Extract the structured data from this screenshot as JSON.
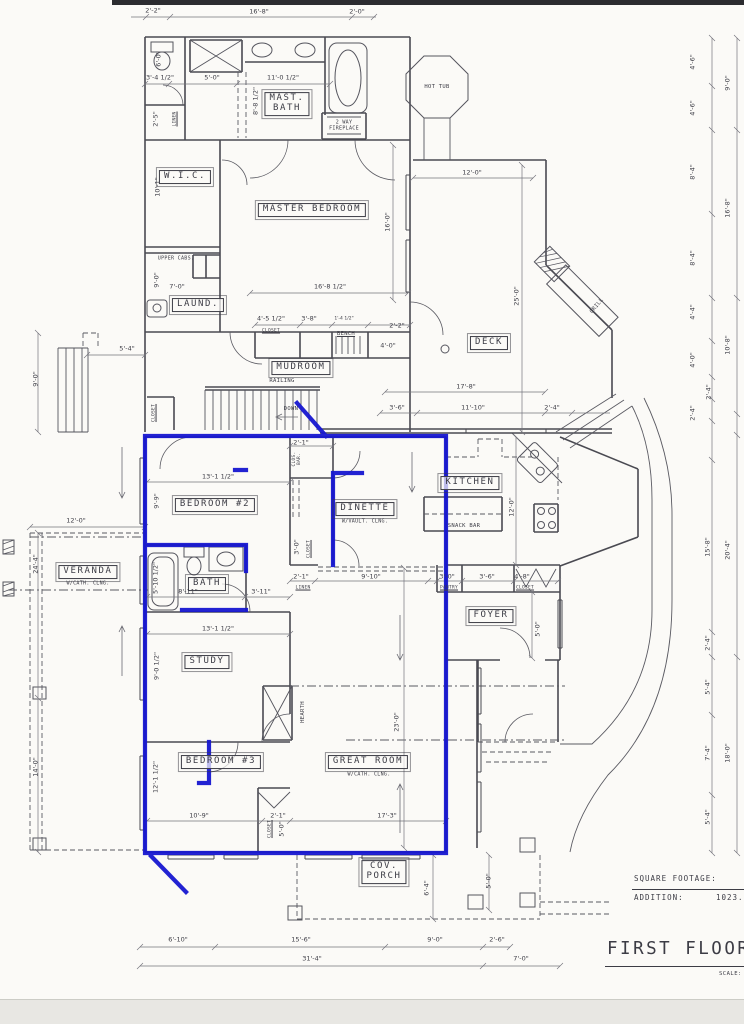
{
  "colors": {
    "highlight_blue": "#1616d0",
    "ink": "#3c3c45",
    "paper": "#fbfaf7"
  },
  "title_block": {
    "square_footage_label": "SQUARE FOOTAGE:",
    "addition_label": "ADDITION:",
    "addition_value": "1023.",
    "sheet_title": "FIRST FLOOR F",
    "scale_label": "SCALE:"
  },
  "rooms": [
    {
      "t": "MAST.\nBATH",
      "x": 287,
      "y": 104,
      "n": "mast-bath"
    },
    {
      "t": "W.I.C.",
      "x": 185,
      "y": 177,
      "n": "wic"
    },
    {
      "t": "MASTER BEDROOM",
      "x": 312,
      "y": 210,
      "n": "master-bedroom"
    },
    {
      "t": "LAUND.",
      "x": 198,
      "y": 305,
      "n": "laundry"
    },
    {
      "t": "MUDROOM",
      "x": 301,
      "y": 368,
      "n": "mudroom"
    },
    {
      "t": "DECK",
      "x": 489,
      "y": 343,
      "n": "deck"
    },
    {
      "t": "KITCHEN",
      "x": 470,
      "y": 483,
      "n": "kitchen"
    },
    {
      "t": "DINETTE",
      "x": 365,
      "y": 509,
      "n": "dinette"
    },
    {
      "t": "BEDROOM #2",
      "x": 215,
      "y": 505,
      "n": "bedroom-2"
    },
    {
      "t": "BATH",
      "x": 207,
      "y": 584,
      "n": "bath"
    },
    {
      "t": "VERANDA",
      "x": 88,
      "y": 572,
      "n": "veranda"
    },
    {
      "t": "STUDY",
      "x": 207,
      "y": 662,
      "n": "study"
    },
    {
      "t": "BEDROOM #3",
      "x": 221,
      "y": 762,
      "n": "bedroom-3"
    },
    {
      "t": "GREAT ROOM",
      "x": 368,
      "y": 762,
      "n": "great-room"
    },
    {
      "t": "FOYER",
      "x": 491,
      "y": 616,
      "n": "foyer"
    },
    {
      "t": "COV.\nPORCH",
      "x": 384,
      "y": 872,
      "n": "cov-porch"
    }
  ],
  "labels": [
    {
      "t": "HOT TUB",
      "x": 437,
      "y": 87
    },
    {
      "t": "2 WAY\nFIREPLACE",
      "x": 344,
      "y": 126,
      "fs": 5
    },
    {
      "t": "GRILL",
      "x": 597,
      "y": 306,
      "rot": -50
    },
    {
      "t": "SNACK BAR",
      "x": 464,
      "y": 526
    },
    {
      "t": "BENCH",
      "x": 346,
      "y": 334,
      "u": 1
    },
    {
      "t": "RAILING",
      "x": 282,
      "y": 381
    },
    {
      "t": "DOWN",
      "x": 291,
      "y": 409
    },
    {
      "t": "UPPER CABS.",
      "x": 176,
      "y": 259,
      "fs": 5
    },
    {
      "t": "HEARTH",
      "x": 303,
      "y": 712,
      "r": 1
    },
    {
      "t": "LINEN",
      "x": 176,
      "y": 119,
      "r": 1,
      "u": 1,
      "fs": 4.5
    },
    {
      "t": "CLOSET",
      "x": 271,
      "y": 332,
      "u": 1,
      "fs": 4.5
    },
    {
      "t": "CLOSET",
      "x": 155,
      "y": 413,
      "r": 1,
      "u": 1,
      "fs": 4.5
    },
    {
      "t": "CLOS.\nBAR.",
      "x": 298,
      "y": 459,
      "r": 1,
      "fs": 4.5
    },
    {
      "t": "CLOSET",
      "x": 310,
      "y": 549,
      "r": 1,
      "u": 1,
      "fs": 4.5
    },
    {
      "t": "LINEN",
      "x": 303,
      "y": 589,
      "u": 1,
      "fs": 4.5
    },
    {
      "t": "PANTRY",
      "x": 449,
      "y": 589,
      "u": 1,
      "fs": 4.5
    },
    {
      "t": "CLOSET",
      "x": 525,
      "y": 589,
      "u": 1,
      "fs": 4.5
    },
    {
      "t": "CLOSET",
      "x": 271,
      "y": 829,
      "r": 1,
      "u": 1,
      "fs": 4.5
    },
    {
      "t": "W/VAULT. CLNG.",
      "x": 365,
      "y": 522,
      "fs": 5
    },
    {
      "t": "W/CATH. CLNG.",
      "x": 88,
      "y": 584,
      "fs": 5
    },
    {
      "t": "W/CATH. CLNG.",
      "x": 369,
      "y": 775,
      "fs": 5
    }
  ],
  "dims": [
    {
      "t": "2'-2\"",
      "x": 153,
      "y": 11
    },
    {
      "t": "16'-8\"",
      "x": 259,
      "y": 12
    },
    {
      "t": "2'-0\"",
      "x": 357,
      "y": 12
    },
    {
      "t": "6'-0\"",
      "x": 159,
      "y": 59,
      "r": 1
    },
    {
      "t": "3'-4 1/2\"",
      "x": 160,
      "y": 78
    },
    {
      "t": "5'-0\"",
      "x": 212,
      "y": 78
    },
    {
      "t": "11'-0 1/2\"",
      "x": 283,
      "y": 78
    },
    {
      "t": "8'-8 1/2\"",
      "x": 256,
      "y": 101,
      "r": 1
    },
    {
      "t": "2'-5\"",
      "x": 156,
      "y": 119,
      "r": 1
    },
    {
      "t": "10'-1\"",
      "x": 158,
      "y": 187,
      "r": 1
    },
    {
      "t": "9'-0\"",
      "x": 157,
      "y": 280,
      "r": 1
    },
    {
      "t": "7'-0\"",
      "x": 177,
      "y": 287
    },
    {
      "t": "16'-0\"",
      "x": 388,
      "y": 222,
      "r": 1
    },
    {
      "t": "16'-8 1/2\"",
      "x": 330,
      "y": 287
    },
    {
      "t": "4'-5 1/2\"",
      "x": 271,
      "y": 319
    },
    {
      "t": "3'-8\"",
      "x": 309,
      "y": 319
    },
    {
      "t": "1'-4 1/2\"",
      "x": 344,
      "y": 320,
      "fs": 4.5
    },
    {
      "t": "2'-2\"",
      "x": 397,
      "y": 326
    },
    {
      "t": "4'-0\"",
      "x": 388,
      "y": 346
    },
    {
      "t": "12'-0\"",
      "x": 472,
      "y": 173
    },
    {
      "t": "25'-0\"",
      "x": 517,
      "y": 296,
      "r": 1
    },
    {
      "t": "17'-8\"",
      "x": 466,
      "y": 387
    },
    {
      "t": "3'-6\"",
      "x": 397,
      "y": 408
    },
    {
      "t": "11'-10\"",
      "x": 473,
      "y": 408
    },
    {
      "t": "2'-4\"",
      "x": 552,
      "y": 408
    },
    {
      "t": "5'-4\"",
      "x": 127,
      "y": 349
    },
    {
      "t": "9'-0\"",
      "x": 36,
      "y": 379,
      "r": 1
    },
    {
      "t": "12'-0\"",
      "x": 76,
      "y": 521
    },
    {
      "t": "24'-4\"",
      "x": 36,
      "y": 564,
      "r": 1
    },
    {
      "t": "14'-0\"",
      "x": 36,
      "y": 767,
      "r": 1
    },
    {
      "t": "2'-1\"",
      "x": 301,
      "y": 443
    },
    {
      "t": "13'-1 1/2\"",
      "x": 218,
      "y": 477
    },
    {
      "t": "9'-9\"",
      "x": 157,
      "y": 501,
      "r": 1
    },
    {
      "t": "3'-0\"",
      "x": 297,
      "y": 547,
      "r": 1
    },
    {
      "t": "5'-10 1/2\"",
      "x": 156,
      "y": 578,
      "r": 1
    },
    {
      "t": "8'-11\"",
      "x": 188,
      "y": 592
    },
    {
      "t": "3'-11\"",
      "x": 261,
      "y": 592
    },
    {
      "t": "2'-1\"",
      "x": 301,
      "y": 577
    },
    {
      "t": "9'-10\"",
      "x": 371,
      "y": 577
    },
    {
      "t": "12'-0\"",
      "x": 512,
      "y": 507,
      "r": 1
    },
    {
      "t": "3'-0\"",
      "x": 447,
      "y": 577
    },
    {
      "t": "3'-6\"",
      "x": 487,
      "y": 577
    },
    {
      "t": "4'-8\"",
      "x": 522,
      "y": 577
    },
    {
      "t": "5'-0\"",
      "x": 538,
      "y": 629,
      "r": 1
    },
    {
      "t": "13'-1 1/2\"",
      "x": 218,
      "y": 629
    },
    {
      "t": "9'-0 1/2\"",
      "x": 157,
      "y": 666,
      "r": 1
    },
    {
      "t": "23'-0\"",
      "x": 397,
      "y": 722,
      "r": 1
    },
    {
      "t": "17'-3\"",
      "x": 387,
      "y": 816
    },
    {
      "t": "12'-1 1/2\"",
      "x": 156,
      "y": 777,
      "r": 1
    },
    {
      "t": "10'-9\"",
      "x": 199,
      "y": 816
    },
    {
      "t": "2'-1\"",
      "x": 278,
      "y": 816
    },
    {
      "t": "5'-0\"",
      "x": 282,
      "y": 829,
      "r": 1
    },
    {
      "t": "6'-4\"",
      "x": 427,
      "y": 888,
      "r": 1
    },
    {
      "t": "5'-0\"",
      "x": 489,
      "y": 881,
      "r": 1
    },
    {
      "t": "6'-10\"",
      "x": 178,
      "y": 940
    },
    {
      "t": "15'-6\"",
      "x": 301,
      "y": 940
    },
    {
      "t": "9'-0\"",
      "x": 435,
      "y": 940
    },
    {
      "t": "2'-6\"",
      "x": 497,
      "y": 940
    },
    {
      "t": "31'-4\"",
      "x": 312,
      "y": 959
    },
    {
      "t": "7'-0\"",
      "x": 521,
      "y": 959
    },
    {
      "t": "4'-6\"",
      "x": 693,
      "y": 62,
      "r": 1
    },
    {
      "t": "9'-0\"",
      "x": 728,
      "y": 83,
      "r": 1
    },
    {
      "t": "4'-6\"",
      "x": 693,
      "y": 108,
      "r": 1
    },
    {
      "t": "8'-4\"",
      "x": 693,
      "y": 172,
      "r": 1
    },
    {
      "t": "16'-8\"",
      "x": 728,
      "y": 208,
      "r": 1
    },
    {
      "t": "8'-4\"",
      "x": 693,
      "y": 258,
      "r": 1
    },
    {
      "t": "4'-4\"",
      "x": 693,
      "y": 312,
      "r": 1
    },
    {
      "t": "10'-8\"",
      "x": 728,
      "y": 345,
      "r": 1
    },
    {
      "t": "4'-0\"",
      "x": 693,
      "y": 360,
      "r": 1
    },
    {
      "t": "2'-4\"",
      "x": 709,
      "y": 392,
      "r": 1
    },
    {
      "t": "2'-4\"",
      "x": 693,
      "y": 413,
      "r": 1
    },
    {
      "t": "15'-8\"",
      "x": 708,
      "y": 547,
      "r": 1
    },
    {
      "t": "20'-4\"",
      "x": 728,
      "y": 550,
      "r": 1
    },
    {
      "t": "2'-4\"",
      "x": 708,
      "y": 643,
      "r": 1
    },
    {
      "t": "5'-4\"",
      "x": 708,
      "y": 687,
      "r": 1
    },
    {
      "t": "7'-4\"",
      "x": 708,
      "y": 753,
      "r": 1
    },
    {
      "t": "18'-0\"",
      "x": 728,
      "y": 753,
      "r": 1
    },
    {
      "t": "5'-4\"",
      "x": 708,
      "y": 817,
      "r": 1
    }
  ]
}
